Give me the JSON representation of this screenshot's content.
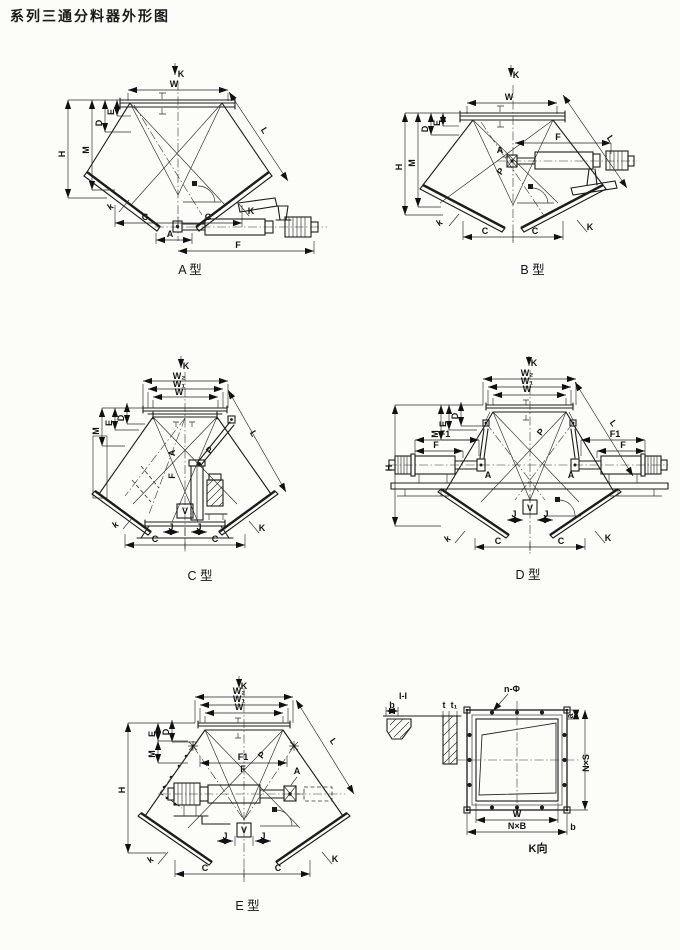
{
  "page": {
    "title": "系列三通分料器外形图"
  },
  "diagrams": [
    {
      "id": "a",
      "caption": "A 型",
      "annotations": [
        {
          "t": "K",
          "x": 146,
          "y": 22,
          "s": 10
        },
        {
          "t": "W",
          "x": 139,
          "y": 32
        },
        {
          "t": "E",
          "x": 79,
          "y": 57,
          "r": -90
        },
        {
          "t": "D",
          "x": 67,
          "y": 68,
          "r": -90
        },
        {
          "t": "M",
          "x": 54,
          "y": 95,
          "r": -90
        },
        {
          "t": "H",
          "x": 30,
          "y": 99,
          "r": -90
        },
        {
          "t": "L",
          "x": 227,
          "y": 77,
          "r": 57
        },
        {
          "t": "k",
          "x": 77,
          "y": 154,
          "r": -35
        },
        {
          "t": "C",
          "x": 110,
          "y": 165
        },
        {
          "t": "C",
          "x": 173,
          "y": 165
        },
        {
          "t": "K",
          "x": 216,
          "y": 159
        },
        {
          "t": "A",
          "x": 135,
          "y": 182
        },
        {
          "t": "F",
          "x": 203,
          "y": 193
        }
      ]
    },
    {
      "id": "b",
      "caption": "B 型",
      "annotations": [
        {
          "t": "K",
          "x": 131,
          "y": 23,
          "s": 10
        },
        {
          "t": "W",
          "x": 124,
          "y": 45
        },
        {
          "t": "E",
          "x": 55,
          "y": 68,
          "r": -90
        },
        {
          "t": "D",
          "x": 43,
          "y": 74,
          "r": -90
        },
        {
          "t": "M",
          "x": 30,
          "y": 108,
          "r": -90
        },
        {
          "t": "H",
          "x": 17,
          "y": 112,
          "r": -90
        },
        {
          "t": "L",
          "x": 223,
          "y": 85,
          "r": 56
        },
        {
          "t": "F",
          "x": 173,
          "y": 85
        },
        {
          "t": "A",
          "x": 115,
          "y": 98,
          "s": 8
        },
        {
          "t": "P",
          "x": 118,
          "y": 118,
          "r": -55,
          "s": 8
        },
        {
          "t": "k",
          "x": 56,
          "y": 170,
          "r": -35
        },
        {
          "t": "C",
          "x": 100,
          "y": 179
        },
        {
          "t": "C",
          "x": 150,
          "y": 179
        },
        {
          "t": "K",
          "x": 205,
          "y": 175
        }
      ]
    },
    {
      "id": "c",
      "caption": "C 型",
      "annotations": [
        {
          "t": "K",
          "x": 101,
          "y": 21,
          "s": 10
        },
        {
          "t": "W₂",
          "x": 94,
          "y": 31,
          "s": 8
        },
        {
          "t": "W₁",
          "x": 94,
          "y": 39,
          "s": 8
        },
        {
          "t": "W",
          "x": 94,
          "y": 47,
          "s": 8
        },
        {
          "t": "D",
          "x": 39,
          "y": 70,
          "r": -90
        },
        {
          "t": "E",
          "x": 27,
          "y": 75,
          "r": -90
        },
        {
          "t": "M",
          "x": 14,
          "y": 83,
          "r": -90
        },
        {
          "t": "L",
          "x": 166,
          "y": 87,
          "r": 60
        },
        {
          "t": "P",
          "x": 127,
          "y": 104,
          "r": -50,
          "s": 8
        },
        {
          "t": "A",
          "x": 90,
          "y": 105,
          "r": -90,
          "s": 8
        },
        {
          "t": "F",
          "x": 90,
          "y": 128,
          "r": -90,
          "s": 8
        },
        {
          "t": "V",
          "x": 100,
          "y": 166,
          "s": 8
        },
        {
          "t": "J",
          "x": 86,
          "y": 182,
          "s": 8
        },
        {
          "t": "J",
          "x": 114,
          "y": 182,
          "s": 8
        },
        {
          "t": "C",
          "x": 70,
          "y": 194
        },
        {
          "t": "C",
          "x": 130,
          "y": 194
        },
        {
          "t": "k",
          "x": 32,
          "y": 179,
          "r": -35
        },
        {
          "t": "K",
          "x": 177,
          "y": 183
        }
      ]
    },
    {
      "id": "d",
      "caption": "D 型",
      "annotations": [
        {
          "t": "K",
          "x": 151,
          "y": 16,
          "s": 10
        },
        {
          "t": "W₂",
          "x": 144,
          "y": 26,
          "s": 8
        },
        {
          "t": "W₁",
          "x": 144,
          "y": 34,
          "s": 8
        },
        {
          "t": "W",
          "x": 144,
          "y": 42,
          "s": 8
        },
        {
          "t": "D",
          "x": 75,
          "y": 66,
          "r": -90
        },
        {
          "t": "E",
          "x": 63,
          "y": 74,
          "r": -90
        },
        {
          "t": "M",
          "x": 55,
          "y": 84,
          "r": -90
        },
        {
          "t": "H",
          "x": 9,
          "y": 118,
          "r": -90
        },
        {
          "t": "F1",
          "x": 62,
          "y": 87,
          "s": 8
        },
        {
          "t": "F",
          "x": 53,
          "y": 98,
          "s": 8
        },
        {
          "t": "F1",
          "x": 232,
          "y": 87,
          "s": 8
        },
        {
          "t": "F",
          "x": 240,
          "y": 98,
          "s": 8
        },
        {
          "t": "A",
          "x": 105,
          "y": 128,
          "s": 8
        },
        {
          "t": "A",
          "x": 188,
          "y": 128,
          "s": 8
        },
        {
          "t": "P",
          "x": 160,
          "y": 84,
          "r": -50,
          "s": 8
        },
        {
          "t": "L",
          "x": 228,
          "y": 75,
          "r": 53
        },
        {
          "t": "V",
          "x": 147,
          "y": 161,
          "s": 8
        },
        {
          "t": "J",
          "x": 131,
          "y": 167,
          "s": 8
        },
        {
          "t": "J",
          "x": 163,
          "y": 167,
          "s": 8
        },
        {
          "t": "C",
          "x": 115,
          "y": 194
        },
        {
          "t": "C",
          "x": 178,
          "y": 194
        },
        {
          "t": "k",
          "x": 66,
          "y": 191,
          "r": -35
        },
        {
          "t": "K",
          "x": 225,
          "y": 191
        }
      ]
    },
    {
      "id": "e",
      "caption": "E 型",
      "annotations": [
        {
          "t": "K",
          "x": 144,
          "y": 21,
          "s": 10
        },
        {
          "t": "W₂",
          "x": 139,
          "y": 26,
          "s": 8
        },
        {
          "t": "W₁",
          "x": 139,
          "y": 34,
          "s": 8
        },
        {
          "t": "W",
          "x": 139,
          "y": 42,
          "s": 8
        },
        {
          "t": "D",
          "x": 69,
          "y": 64,
          "r": -90
        },
        {
          "t": "E",
          "x": 55,
          "y": 66,
          "r": -90
        },
        {
          "t": "M",
          "x": 55,
          "y": 86,
          "r": -90
        },
        {
          "t": "H",
          "x": 25,
          "y": 122,
          "r": -90
        },
        {
          "t": "F1",
          "x": 143,
          "y": 92,
          "s": 8
        },
        {
          "t": "F",
          "x": 143,
          "y": 104,
          "s": 8
        },
        {
          "t": "A",
          "x": 197,
          "y": 106,
          "s": 8
        },
        {
          "t": "P",
          "x": 164,
          "y": 89,
          "r": -50,
          "s": 8
        },
        {
          "t": "L",
          "x": 231,
          "y": 75,
          "r": 55
        },
        {
          "t": "V",
          "x": 144,
          "y": 165,
          "s": 8
        },
        {
          "t": "J",
          "x": 125,
          "y": 171,
          "s": 8
        },
        {
          "t": "J",
          "x": 163,
          "y": 171,
          "s": 8
        },
        {
          "t": "C",
          "x": 105,
          "y": 203
        },
        {
          "t": "C",
          "x": 178,
          "y": 203
        },
        {
          "t": "k",
          "x": 52,
          "y": 194,
          "r": -35
        },
        {
          "t": "K",
          "x": 235,
          "y": 194
        }
      ]
    },
    {
      "id": "ii",
      "caption": "",
      "annotations": [
        {
          "t": "I-I",
          "x": 20,
          "y": 14,
          "s": 11
        },
        {
          "t": "b",
          "x": 9,
          "y": 23
        },
        {
          "t": "t",
          "x": 61,
          "y": 23,
          "s": 7
        },
        {
          "t": "t₁",
          "x": 71,
          "y": 23,
          "s": 7
        }
      ]
    },
    {
      "id": "kview",
      "caption": "K向",
      "annotations": [
        {
          "t": "n-Φ",
          "x": 60,
          "y": 9,
          "s": 8
        },
        {
          "t": "a",
          "x": 121,
          "y": 33,
          "r": -90,
          "s": 7
        },
        {
          "t": "N×S",
          "x": 137,
          "y": 80,
          "r": -90
        },
        {
          "t": "W",
          "x": 65,
          "y": 134
        },
        {
          "t": "N×B",
          "x": 65,
          "y": 146
        },
        {
          "t": "b",
          "x": 121,
          "y": 147
        }
      ]
    }
  ]
}
